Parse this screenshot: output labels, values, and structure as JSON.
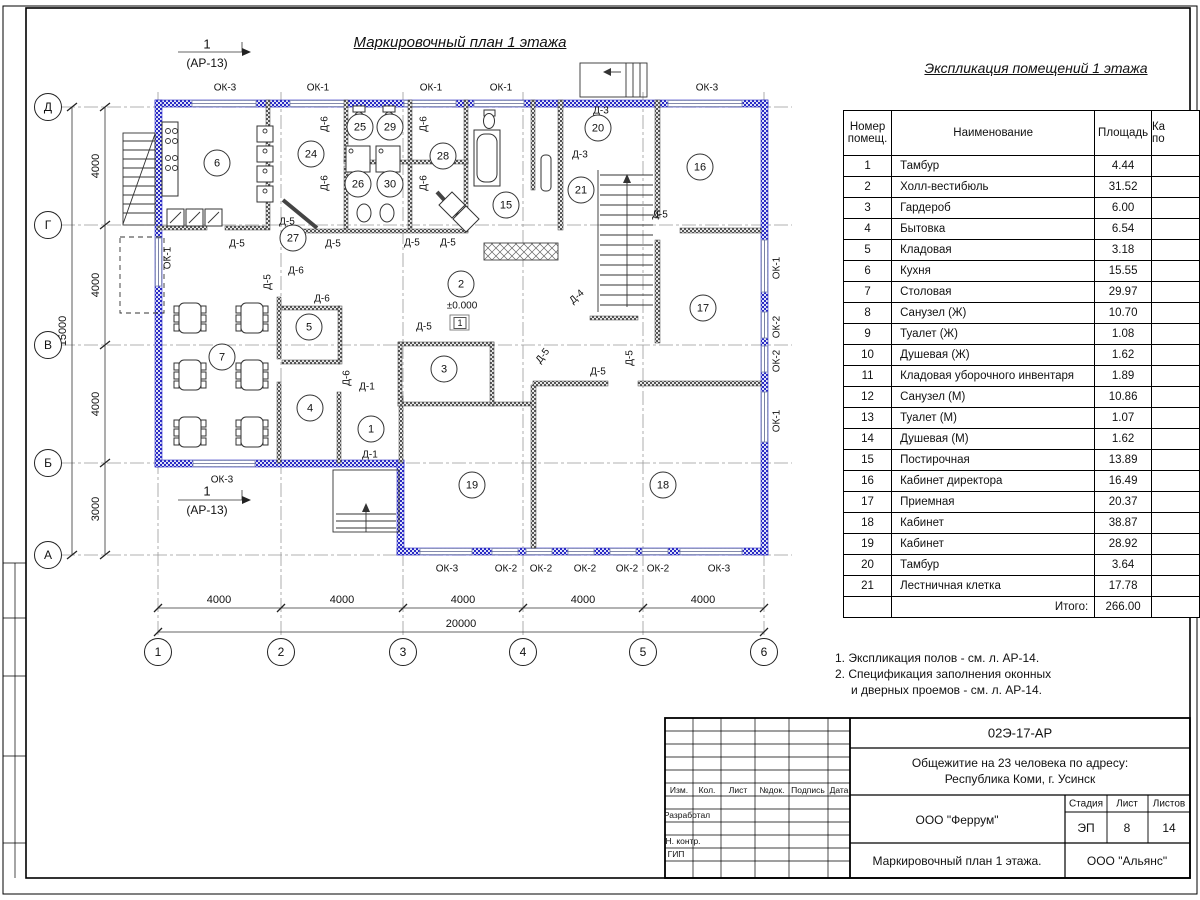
{
  "titles": {
    "plan": "Маркировочный план 1 этажа",
    "table": "Экспликация помещений 1 этажа"
  },
  "table": {
    "col_number": [
      "Номер",
      "помещ."
    ],
    "col_name": "Наименование",
    "col_area": "Площадь",
    "col_cut": [
      "Ка",
      "по"
    ],
    "rows": [
      {
        "n": "1",
        "name": "Тамбур",
        "area": "4.44"
      },
      {
        "n": "2",
        "name": "Холл-вестибюль",
        "area": "31.52"
      },
      {
        "n": "3",
        "name": "Гардероб",
        "area": "6.00"
      },
      {
        "n": "4",
        "name": "Бытовка",
        "area": "6.54"
      },
      {
        "n": "5",
        "name": "Кладовая",
        "area": "3.18"
      },
      {
        "n": "6",
        "name": "Кухня",
        "area": "15.55"
      },
      {
        "n": "7",
        "name": "Столовая",
        "area": "29.97"
      },
      {
        "n": "8",
        "name": "Санузел (Ж)",
        "area": "10.70"
      },
      {
        "n": "9",
        "name": "Туалет (Ж)",
        "area": "1.08"
      },
      {
        "n": "10",
        "name": "Душевая (Ж)",
        "area": "1.62"
      },
      {
        "n": "11",
        "name": "Кладовая уборочного инвентаря",
        "area": "1.89"
      },
      {
        "n": "12",
        "name": "Санузел (М)",
        "area": "10.86"
      },
      {
        "n": "13",
        "name": "Туалет (М)",
        "area": "1.07"
      },
      {
        "n": "14",
        "name": "Душевая (М)",
        "area": "1.62"
      },
      {
        "n": "15",
        "name": "Постирочная",
        "area": "13.89"
      },
      {
        "n": "16",
        "name": "Кабинет директора",
        "area": "16.49"
      },
      {
        "n": "17",
        "name": "Приемная",
        "area": "20.37"
      },
      {
        "n": "18",
        "name": "Кабинет",
        "area": "38.87"
      },
      {
        "n": "19",
        "name": "Кабинет",
        "area": "28.92"
      },
      {
        "n": "20",
        "name": "Тамбур",
        "area": "3.64"
      },
      {
        "n": "21",
        "name": "Лестничная клетка",
        "area": "17.78"
      }
    ],
    "total_label": "Итого:",
    "total": "266.00"
  },
  "notes": [
    "1. Экспликация полов - см. л. АР-14.",
    "2. Спецификация заполнения оконных",
    "и дверных проемов - см. л. АР-14."
  ],
  "title_block": {
    "doc": "02Э-17-АР",
    "project": [
      "Общежитие на 23 человека по адресу:",
      "Республика Коми, г. Усинск"
    ],
    "cols": [
      "Изм.",
      "Кол.",
      "Лист",
      "№док.",
      "Подпись",
      "Дата"
    ],
    "row_labels": [
      "Разработал",
      "Н. контр.",
      "ГИП"
    ],
    "org": "ООО \"Феррум\"",
    "stage_label": "Стадия",
    "sheet_label": "Лист",
    "sheets_label": "Листов",
    "stage": "ЭП",
    "sheet": "8",
    "sheets": "14",
    "drawing_name": "Маркировочный план 1 этажа.",
    "org2": "ООО \"Альянс\""
  },
  "plan": {
    "axis_rows": [
      {
        "label": "Д",
        "y": 107
      },
      {
        "label": "Г",
        "y": 225
      },
      {
        "label": "В",
        "y": 345
      },
      {
        "label": "Б",
        "y": 463
      },
      {
        "label": "А",
        "y": 555
      }
    ],
    "axis_cols": [
      {
        "label": "1",
        "x": 158
      },
      {
        "label": "2",
        "x": 281
      },
      {
        "label": "3",
        "x": 403
      },
      {
        "label": "4",
        "x": 523
      },
      {
        "label": "5",
        "x": 643
      },
      {
        "label": "6",
        "x": 764
      }
    ],
    "rooms": [
      {
        "num": "6",
        "x": 217,
        "y": 163
      },
      {
        "num": "24",
        "x": 311,
        "y": 154
      },
      {
        "num": "25",
        "x": 360,
        "y": 127
      },
      {
        "num": "29",
        "x": 390,
        "y": 127
      },
      {
        "num": "26",
        "x": 358,
        "y": 184
      },
      {
        "num": "30",
        "x": 390,
        "y": 184
      },
      {
        "num": "28",
        "x": 443,
        "y": 156
      },
      {
        "num": "27",
        "x": 293,
        "y": 238
      },
      {
        "num": "15",
        "x": 506,
        "y": 205
      },
      {
        "num": "20",
        "x": 598,
        "y": 128
      },
      {
        "num": "21",
        "x": 581,
        "y": 190
      },
      {
        "num": "16",
        "x": 700,
        "y": 167
      },
      {
        "num": "5",
        "x": 309,
        "y": 327
      },
      {
        "num": "7",
        "x": 222,
        "y": 357
      },
      {
        "num": "2",
        "x": 461,
        "y": 284
      },
      {
        "num": "3",
        "x": 444,
        "y": 369
      },
      {
        "num": "4",
        "x": 310,
        "y": 408
      },
      {
        "num": "1",
        "x": 371,
        "y": 429
      },
      {
        "num": "17",
        "x": 703,
        "y": 308
      },
      {
        "num": "19",
        "x": 472,
        "y": 485
      },
      {
        "num": "18",
        "x": 663,
        "y": 485
      }
    ],
    "labels": [
      {
        "t": "ОК-3",
        "x": 225,
        "y": 88,
        "n": "window-label"
      },
      {
        "t": "ОК-1",
        "x": 318,
        "y": 88,
        "n": "window-label"
      },
      {
        "t": "ОК-1",
        "x": 431,
        "y": 88,
        "n": "window-label"
      },
      {
        "t": "ОК-1",
        "x": 501,
        "y": 88,
        "n": "window-label"
      },
      {
        "t": "ОК-3",
        "x": 707,
        "y": 88,
        "n": "window-label"
      },
      {
        "t": "ОК-3",
        "x": 447,
        "y": 569,
        "n": "window-label"
      },
      {
        "t": "ОК-2",
        "x": 506,
        "y": 569,
        "n": "window-label"
      },
      {
        "t": "ОК-2",
        "x": 541,
        "y": 569,
        "n": "window-label"
      },
      {
        "t": "ОК-2",
        "x": 585,
        "y": 569,
        "n": "window-label"
      },
      {
        "t": "ОК-2",
        "x": 627,
        "y": 569,
        "n": "window-label"
      },
      {
        "t": "ОК-2",
        "x": 658,
        "y": 569,
        "n": "window-label"
      },
      {
        "t": "ОК-3",
        "x": 719,
        "y": 569,
        "n": "window-label"
      },
      {
        "t": "ОК-3",
        "x": 222,
        "y": 480,
        "n": "window-label"
      },
      {
        "t": "ОК-1",
        "x": 168,
        "y": 258,
        "r": -90,
        "n": "window-label"
      },
      {
        "t": "ОК-1",
        "x": 777,
        "y": 268,
        "r": -90,
        "n": "window-label"
      },
      {
        "t": "ОК-2",
        "x": 777,
        "y": 327,
        "r": -90,
        "n": "window-label"
      },
      {
        "t": "ОК-2",
        "x": 777,
        "y": 361,
        "r": -90,
        "n": "window-label"
      },
      {
        "t": "ОК-1",
        "x": 777,
        "y": 421,
        "r": -90,
        "n": "window-label"
      },
      {
        "t": "Д-6",
        "x": 325,
        "y": 124,
        "r": -90,
        "n": "door-label"
      },
      {
        "t": "Д-6",
        "x": 424,
        "y": 124,
        "r": -90,
        "n": "door-label"
      },
      {
        "t": "Д-6",
        "x": 325,
        "y": 183,
        "r": -90,
        "n": "door-label"
      },
      {
        "t": "Д-6",
        "x": 424,
        "y": 183,
        "r": -90,
        "n": "door-label"
      },
      {
        "t": "Д-5",
        "x": 287,
        "y": 222,
        "n": "door-label"
      },
      {
        "t": "Д-5",
        "x": 237,
        "y": 244,
        "n": "door-label"
      },
      {
        "t": "Д-5",
        "x": 333,
        "y": 244,
        "n": "door-label"
      },
      {
        "t": "Д-5",
        "x": 412,
        "y": 243,
        "n": "door-label"
      },
      {
        "t": "Д-5",
        "x": 448,
        "y": 243,
        "n": "door-label"
      },
      {
        "t": "Д-5",
        "x": 268,
        "y": 282,
        "r": -90,
        "n": "door-label"
      },
      {
        "t": "Д-6",
        "x": 296,
        "y": 271,
        "n": "door-label"
      },
      {
        "t": "Д-6",
        "x": 322,
        "y": 299,
        "n": "door-label"
      },
      {
        "t": "Д-6",
        "x": 347,
        "y": 378,
        "r": -90,
        "n": "door-label"
      },
      {
        "t": "Д-1",
        "x": 367,
        "y": 387,
        "n": "door-label"
      },
      {
        "t": "Д-1",
        "x": 370,
        "y": 455,
        "n": "door-label"
      },
      {
        "t": "Д-5",
        "x": 424,
        "y": 327,
        "n": "door-label"
      },
      {
        "t": "Д-4",
        "x": 577,
        "y": 297,
        "r": -42,
        "n": "door-label"
      },
      {
        "t": "Д-5",
        "x": 543,
        "y": 356,
        "r": -52,
        "n": "door-label"
      },
      {
        "t": "Д-5",
        "x": 598,
        "y": 372,
        "n": "door-label"
      },
      {
        "t": "Д-5",
        "x": 630,
        "y": 358,
        "r": -90,
        "n": "door-label"
      },
      {
        "t": "Д-3",
        "x": 601,
        "y": 111,
        "n": "door-label"
      },
      {
        "t": "Д-3",
        "x": 580,
        "y": 155,
        "n": "door-label"
      },
      {
        "t": "Д-5",
        "x": 660,
        "y": 215,
        "n": "door-label"
      },
      {
        "t": "4000",
        "x": 219,
        "y": 600,
        "fs": 11,
        "n": "dim-label"
      },
      {
        "t": "4000",
        "x": 342,
        "y": 600,
        "fs": 11,
        "n": "dim-label"
      },
      {
        "t": "4000",
        "x": 463,
        "y": 600,
        "fs": 11,
        "n": "dim-label"
      },
      {
        "t": "4000",
        "x": 583,
        "y": 600,
        "fs": 11,
        "n": "dim-label"
      },
      {
        "t": "4000",
        "x": 703,
        "y": 600,
        "fs": 11,
        "n": "dim-label"
      },
      {
        "t": "20000",
        "x": 461,
        "y": 624,
        "fs": 11,
        "n": "dim-label"
      },
      {
        "t": "4000",
        "x": 96,
        "y": 166,
        "r": -90,
        "fs": 11,
        "n": "dim-label"
      },
      {
        "t": "4000",
        "x": 96,
        "y": 285,
        "r": -90,
        "fs": 11,
        "n": "dim-label"
      },
      {
        "t": "4000",
        "x": 96,
        "y": 404,
        "r": -90,
        "fs": 11,
        "n": "dim-label"
      },
      {
        "t": "3000",
        "x": 96,
        "y": 509,
        "r": -90,
        "fs": 11,
        "n": "dim-label"
      },
      {
        "t": "15000",
        "x": 63,
        "y": 331,
        "r": -90,
        "fs": 11,
        "n": "dim-label"
      },
      {
        "t": "1",
        "x": 207,
        "y": 44,
        "fs": 13,
        "n": "section-mark-number"
      },
      {
        "t": "(АР-13)",
        "x": 207,
        "y": 63,
        "fs": 12,
        "n": "section-mark-ref"
      },
      {
        "t": "1",
        "x": 207,
        "y": 491,
        "fs": 13,
        "n": "section-mark-number"
      },
      {
        "t": "(АР-13)",
        "x": 207,
        "y": 510,
        "fs": 12,
        "n": "section-mark-ref"
      },
      {
        "t": "±0.000",
        "x": 462,
        "y": 306,
        "n": "elevation-label"
      },
      {
        "t": "1",
        "x": 460,
        "y": 323,
        "fs": 9,
        "box": true,
        "n": "floor-type-mark"
      }
    ]
  }
}
